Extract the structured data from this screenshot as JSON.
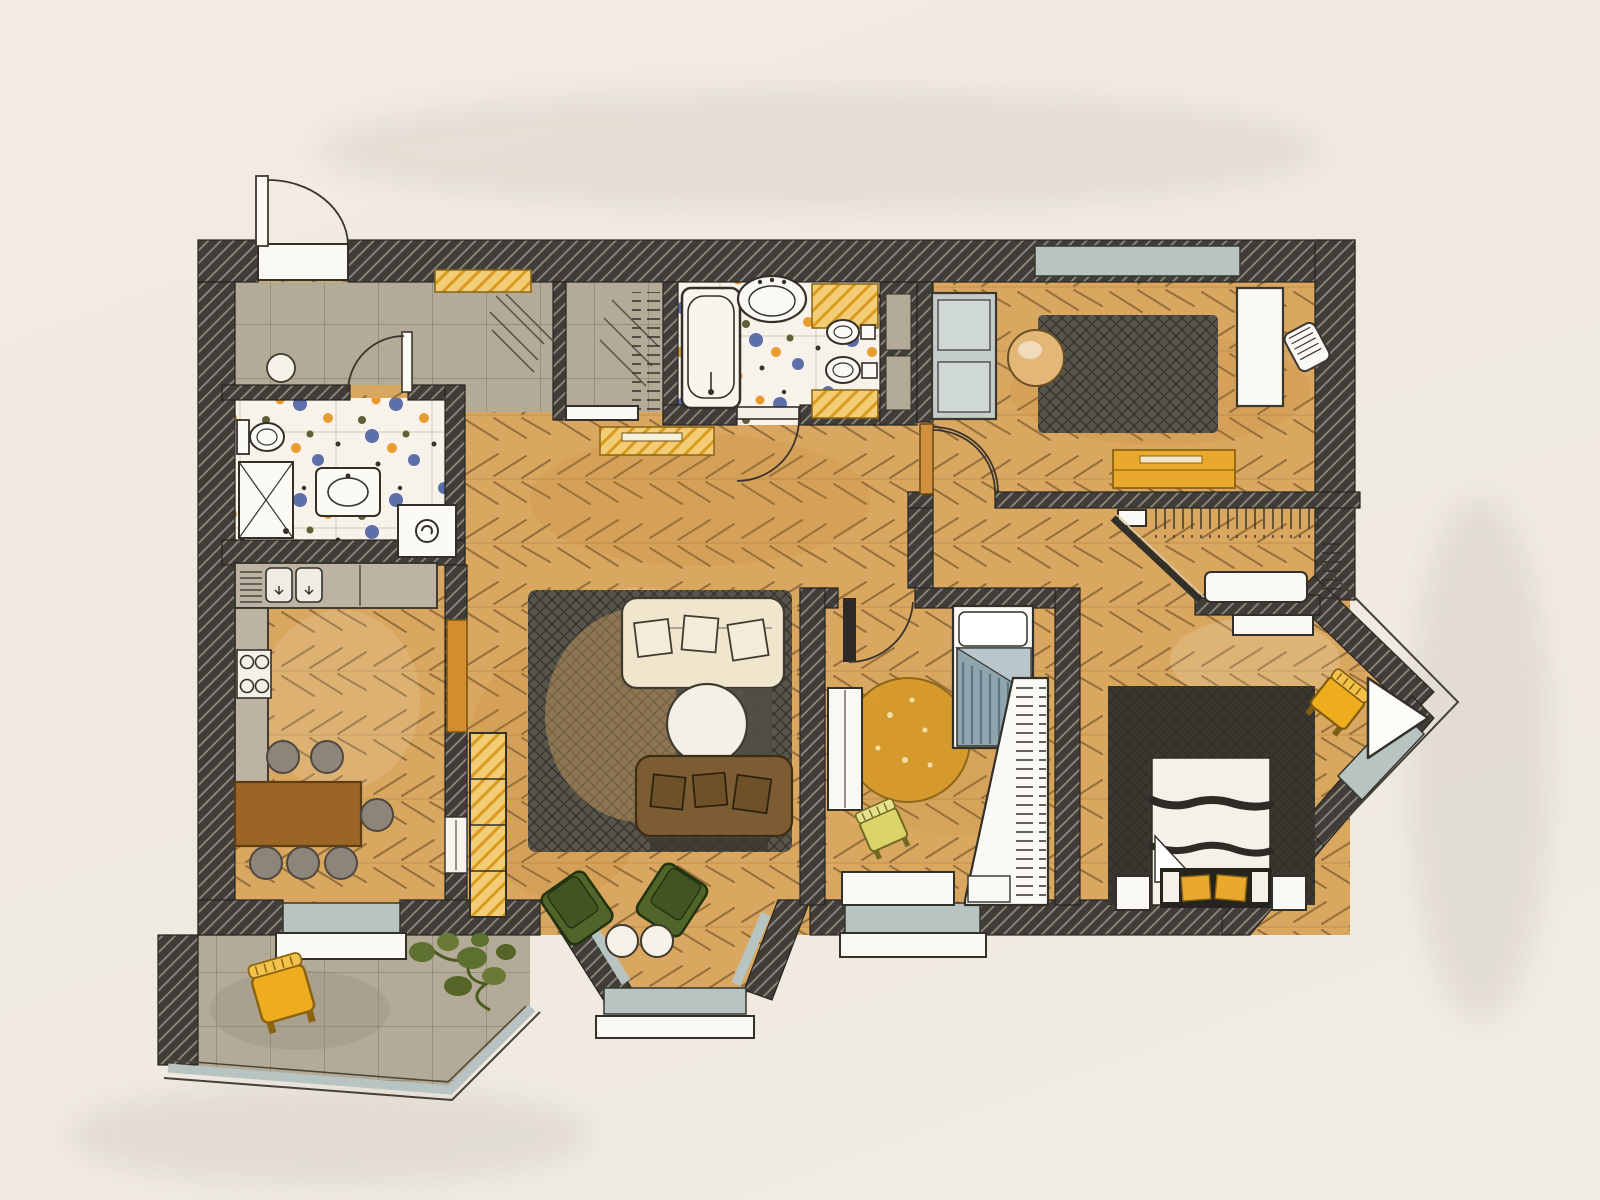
{
  "document": {
    "type": "hand-drawn apartment floor plan",
    "medium": "ink and marker sketch on paper",
    "text_labels": []
  },
  "palette": {
    "paper": "#efe9e0",
    "wall": "#403d38",
    "wall_hatch": "#8b887d",
    "wood": "#d9a75f",
    "wood_line": "#6e5128",
    "tile_gray": "#b4aa98",
    "tile_line": "#867e6c",
    "mosaic_base": "#f7f3ea",
    "mosaic_blue": "#5d6fa8",
    "mosaic_orange": "#e99b2e",
    "mosaic_olive": "#5c6033",
    "glass": "#b7c4c2",
    "accent_yellow": "#eead1f",
    "accent_green": "#51652a",
    "sofa_cream": "#efe6cd",
    "sofa_brown": "#7c5c33",
    "table_brown": "#9b6526",
    "rug_dark": "#57544b",
    "rug_round": "#d79a2a",
    "bed_dark": "#2e2b26",
    "blanket": "#8fa5ad"
  },
  "rooms": [
    {
      "id": "entry-hall",
      "floor": "grey-tile",
      "features": [
        "entrance-door-with-swing",
        "doormat",
        "pouf",
        "yellow-wall-shelf"
      ]
    },
    {
      "id": "guest-bathroom",
      "floor": "mosaic-tile",
      "features": [
        "toilet",
        "shower-stall",
        "washbasin",
        "washing-machine"
      ]
    },
    {
      "id": "hall-closet",
      "floor": "grey-tile",
      "features": [
        "hanging-rail"
      ]
    },
    {
      "id": "bathroom",
      "floor": "mosaic-tile",
      "features": [
        "bathtub",
        "washbasin",
        "bidet",
        "toilet",
        "yellow-cabinets",
        "door-with-swing"
      ]
    },
    {
      "id": "kitchen",
      "floor": "wood-parquet",
      "features": [
        "counter-with-double-sink",
        "dish-rack",
        "cooktop",
        "tall-cabinet",
        "dining-table",
        "six-stools",
        "window",
        "glass-door"
      ]
    },
    {
      "id": "living-room",
      "floor": "wood-parquet",
      "features": [
        "bookshelf",
        "area-rug",
        "cream-sofa-3-pillows",
        "brown-sofa-3-pillows",
        "round-coffee-table",
        "two-green-armchairs",
        "two-round-side-tables",
        "trapezoid-bay-window"
      ]
    },
    {
      "id": "office",
      "floor": "wood-parquet",
      "features": [
        "double-cabinet",
        "dark-rug",
        "round-table",
        "desk",
        "desk-chair",
        "yellow-sideboard",
        "window"
      ]
    },
    {
      "id": "kids-room",
      "floor": "wood-parquet",
      "features": [
        "single-bed-striped-blanket",
        "round-yellow-rug",
        "kids-chair",
        "wall-desk",
        "low-cabinet",
        "corner-wardrobe",
        "window",
        "door-with-swing"
      ]
    },
    {
      "id": "walk-in-closet",
      "floor": "wood-parquet",
      "features": [
        "hanging-rails",
        "bench",
        "diagonal-sliding-partition",
        "shelf"
      ]
    },
    {
      "id": "bedroom",
      "floor": "wood-parquet",
      "features": [
        "double-bed-dark-frame",
        "foot-bench-yellow-pillows",
        "two-nightstands",
        "dresser",
        "yellow-chair",
        "pointed-bay-window-with-seat"
      ]
    },
    {
      "id": "balcony",
      "floor": "grey-tile",
      "features": [
        "yellow-armchair",
        "potted-plant",
        "glazing"
      ]
    }
  ],
  "counts": {
    "stools": 6,
    "sofas": 2,
    "armchairs_green": 2,
    "beds": 2,
    "bay_windows": 2,
    "yellow_chairs": 3
  }
}
